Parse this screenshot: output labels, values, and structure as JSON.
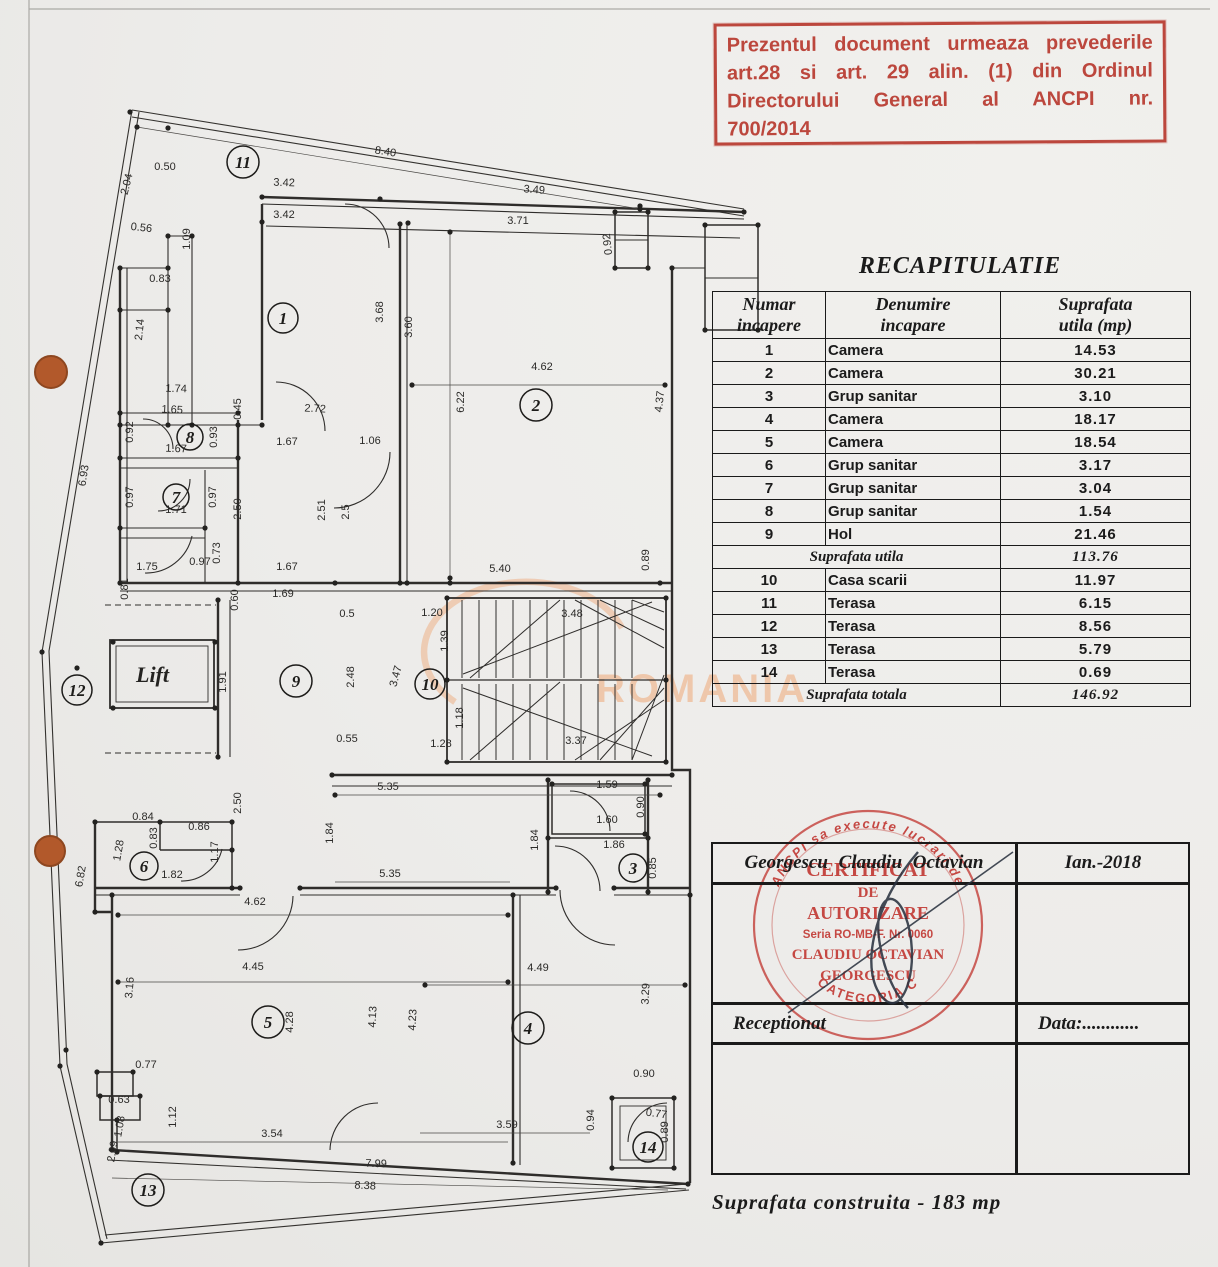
{
  "red_stamp": {
    "lines": [
      "Prezentul document urmeaza prevederile",
      "art.28 si art. 29 alin. (1) din Ordinul",
      "Directorului General al ANCPI nr.",
      "700/2014"
    ]
  },
  "recap": {
    "title": "RECAPITULATIE",
    "headers": [
      {
        "l1": "Numar",
        "l2": "incapere"
      },
      {
        "l1": "Denumire",
        "l2": "incapare"
      },
      {
        "l1": "Suprafata",
        "l2": "utila  (mp)"
      }
    ],
    "rows1": [
      {
        "nr": "1",
        "name": "Camera",
        "area": "14.53"
      },
      {
        "nr": "2",
        "name": "Camera",
        "area": "30.21"
      },
      {
        "nr": "3",
        "name": "Grup sanitar",
        "area": "3.10"
      },
      {
        "nr": "4",
        "name": "Camera",
        "area": "18.17"
      },
      {
        "nr": "5",
        "name": "Camera",
        "area": "18.54"
      },
      {
        "nr": "6",
        "name": "Grup sanitar",
        "area": "3.17"
      },
      {
        "nr": "7",
        "name": "Grup sanitar",
        "area": "3.04"
      },
      {
        "nr": "8",
        "name": "Grup sanitar",
        "area": "1.54"
      },
      {
        "nr": "9",
        "name": "Hol",
        "area": "21.46"
      }
    ],
    "subtotal_label": "Suprafata  utila",
    "subtotal_value": "113.76",
    "rows2": [
      {
        "nr": "10",
        "name": "Casa scarii",
        "area": "11.97"
      },
      {
        "nr": "11",
        "name": "Terasa",
        "area": "6.15"
      },
      {
        "nr": "12",
        "name": "Terasa",
        "area": "8.56"
      },
      {
        "nr": "13",
        "name": "Terasa",
        "area": "5.79"
      },
      {
        "nr": "14",
        "name": "Terasa",
        "area": "0.69"
      }
    ],
    "total_label": "Suprafata  totala",
    "total_value": "146.92"
  },
  "sign_table": {
    "name": "Georgescu  Claudiu  Octavian",
    "date": "Ian.-2018",
    "receptionat": "Receptionat",
    "data_label": "Data:............"
  },
  "round_stamp": {
    "ring_top": "ANCPI sa execute lucrari de",
    "line1": "CERTIFICAT",
    "line2": "DE",
    "line3": "AUTORIZARE",
    "line4": "Seria RO-MB-F. Nr. 0060",
    "line5": "CLAUDIU OCTAVIAN",
    "line6": "GEORGESCU",
    "ring_bottom": "CATEGORIA C"
  },
  "footer": {
    "text": "Suprafata  construita  -  183  mp"
  },
  "watermark": {
    "text": "ROMANIA"
  },
  "plan": {
    "lift_label": "Lift",
    "rooms": [
      [
        "1",
        283,
        318,
        15
      ],
      [
        "2",
        536,
        405,
        16
      ],
      [
        "3",
        633,
        868,
        14
      ],
      [
        "4",
        528,
        1028,
        16
      ],
      [
        "5",
        268,
        1022,
        16
      ],
      [
        "6",
        144,
        866,
        14
      ],
      [
        "7",
        176,
        497,
        13
      ],
      [
        "8",
        190,
        437,
        13
      ],
      [
        "9",
        296,
        681,
        16
      ],
      [
        "10",
        430,
        684,
        15
      ],
      [
        "11",
        243,
        162,
        16
      ],
      [
        "12",
        77,
        690,
        15
      ],
      [
        "13",
        148,
        1190,
        16
      ],
      [
        "14",
        648,
        1147,
        15
      ]
    ],
    "dims": [
      [
        "8.40",
        385,
        155,
        9
      ],
      [
        "3.42",
        284,
        186,
        2
      ],
      [
        "3.42",
        284,
        218,
        0
      ],
      [
        "3.49",
        534,
        193,
        4
      ],
      [
        "3.71",
        518,
        224,
        0
      ],
      [
        "0.50",
        165,
        170,
        0
      ],
      [
        "2.04",
        130,
        185,
        -76
      ],
      [
        "0.56",
        141,
        231,
        6
      ],
      [
        "1.09",
        190,
        239,
        -90
      ],
      [
        "0.83",
        160,
        282,
        0
      ],
      [
        "2.14",
        143,
        330,
        -84
      ],
      [
        "0.92",
        611,
        244,
        -96
      ],
      [
        "1.74",
        176,
        392,
        2
      ],
      [
        "1.65",
        172,
        413,
        3
      ],
      [
        "0.92",
        133,
        432,
        -90
      ],
      [
        "0.93",
        217,
        437,
        -90
      ],
      [
        "0.45",
        241,
        409,
        -90
      ],
      [
        "1.67",
        176,
        452,
        2
      ],
      [
        "2.72",
        315,
        412,
        3
      ],
      [
        "1.67",
        287,
        445,
        0
      ],
      [
        "1.06",
        370,
        444,
        0
      ],
      [
        "0.97",
        133,
        497,
        -90
      ],
      [
        "0.97",
        216,
        497,
        -90
      ],
      [
        "1.71",
        176,
        513,
        0
      ],
      [
        "2.50",
        241,
        509,
        -90
      ],
      [
        "2.51",
        325,
        510,
        -90
      ],
      [
        "2.5",
        349,
        512,
        -90
      ],
      [
        "0.81",
        128,
        589,
        -90
      ],
      [
        "0.73",
        220,
        553,
        -90
      ],
      [
        "0.97",
        200,
        565,
        0
      ],
      [
        "1.75",
        147,
        570,
        0
      ],
      [
        "1.67",
        287,
        570,
        0
      ],
      [
        "1.69",
        283,
        597,
        0
      ],
      [
        "0.60",
        238,
        600,
        -90
      ],
      [
        "5.40",
        500,
        572,
        0
      ],
      [
        "0.89",
        649,
        560,
        -90
      ],
      [
        "6.22",
        464,
        402,
        -90
      ],
      [
        "3.60",
        412,
        327,
        -90
      ],
      [
        "3.68",
        383,
        312,
        -90
      ],
      [
        "4.62",
        542,
        370,
        0
      ],
      [
        "4.37",
        663,
        402,
        -84
      ],
      [
        "6.93",
        87,
        476,
        -81
      ],
      [
        "0.5",
        347,
        617,
        0
      ],
      [
        "1.20",
        432,
        616,
        0
      ],
      [
        "1.39",
        448,
        641,
        -90
      ],
      [
        "3.48",
        572,
        617,
        0
      ],
      [
        "2.48",
        354,
        677,
        -90
      ],
      [
        "1.91",
        226,
        682,
        -90
      ],
      [
        "3.47",
        399,
        677,
        -75
      ],
      [
        "1.18",
        463,
        718,
        -90
      ],
      [
        "0.55",
        347,
        742,
        0
      ],
      [
        "1.28",
        441,
        747,
        0
      ],
      [
        "3.37",
        576,
        744,
        0
      ],
      [
        "5.35",
        388,
        790,
        0
      ],
      [
        "1.59",
        607,
        788,
        0
      ],
      [
        "0.90",
        644,
        807,
        -90
      ],
      [
        "1.60",
        607,
        823,
        0
      ],
      [
        "1.86",
        614,
        848,
        0
      ],
      [
        "0.85",
        656,
        868,
        -90
      ],
      [
        "1.84",
        538,
        840,
        -90
      ],
      [
        "1.84",
        333,
        833,
        -90
      ],
      [
        "2.50",
        241,
        803,
        -90
      ],
      [
        "0.84",
        143,
        820,
        0
      ],
      [
        "0.86",
        199,
        830,
        0
      ],
      [
        "0.83",
        157,
        838,
        -90
      ],
      [
        "1.28",
        122,
        851,
        -80
      ],
      [
        "1.17",
        218,
        852,
        -90
      ],
      [
        "1.82",
        172,
        878,
        0
      ],
      [
        "4.62",
        255,
        905,
        0
      ],
      [
        "5.35",
        390,
        877,
        0
      ],
      [
        "4.45",
        253,
        970,
        0
      ],
      [
        "3.16",
        133,
        988,
        -85
      ],
      [
        "6.82",
        84,
        877,
        -80
      ],
      [
        "4.28",
        293,
        1022,
        -90
      ],
      [
        "4.13",
        376,
        1017,
        -87
      ],
      [
        "4.23",
        416,
        1020,
        -87
      ],
      [
        "4.49",
        538,
        971,
        0
      ],
      [
        "3.29",
        649,
        994,
        -87
      ],
      [
        "0.77",
        146,
        1068,
        0
      ],
      [
        "1.12",
        176,
        1117,
        -90
      ],
      [
        "3.54",
        272,
        1137,
        0
      ],
      [
        "3.59",
        507,
        1128,
        0
      ],
      [
        "0.94",
        594,
        1120,
        -90
      ],
      [
        "0.90",
        644,
        1077,
        0
      ],
      [
        "0.77",
        656,
        1117,
        8
      ],
      [
        "0.89",
        668,
        1132,
        -90
      ],
      [
        "7.99",
        376,
        1167,
        2
      ],
      [
        "8.38",
        365,
        1189,
        3
      ],
      [
        "0.63",
        119,
        1103,
        0
      ],
      [
        "1.08",
        123,
        1127,
        -80
      ],
      [
        "2.09",
        116,
        1152,
        -80
      ]
    ]
  }
}
